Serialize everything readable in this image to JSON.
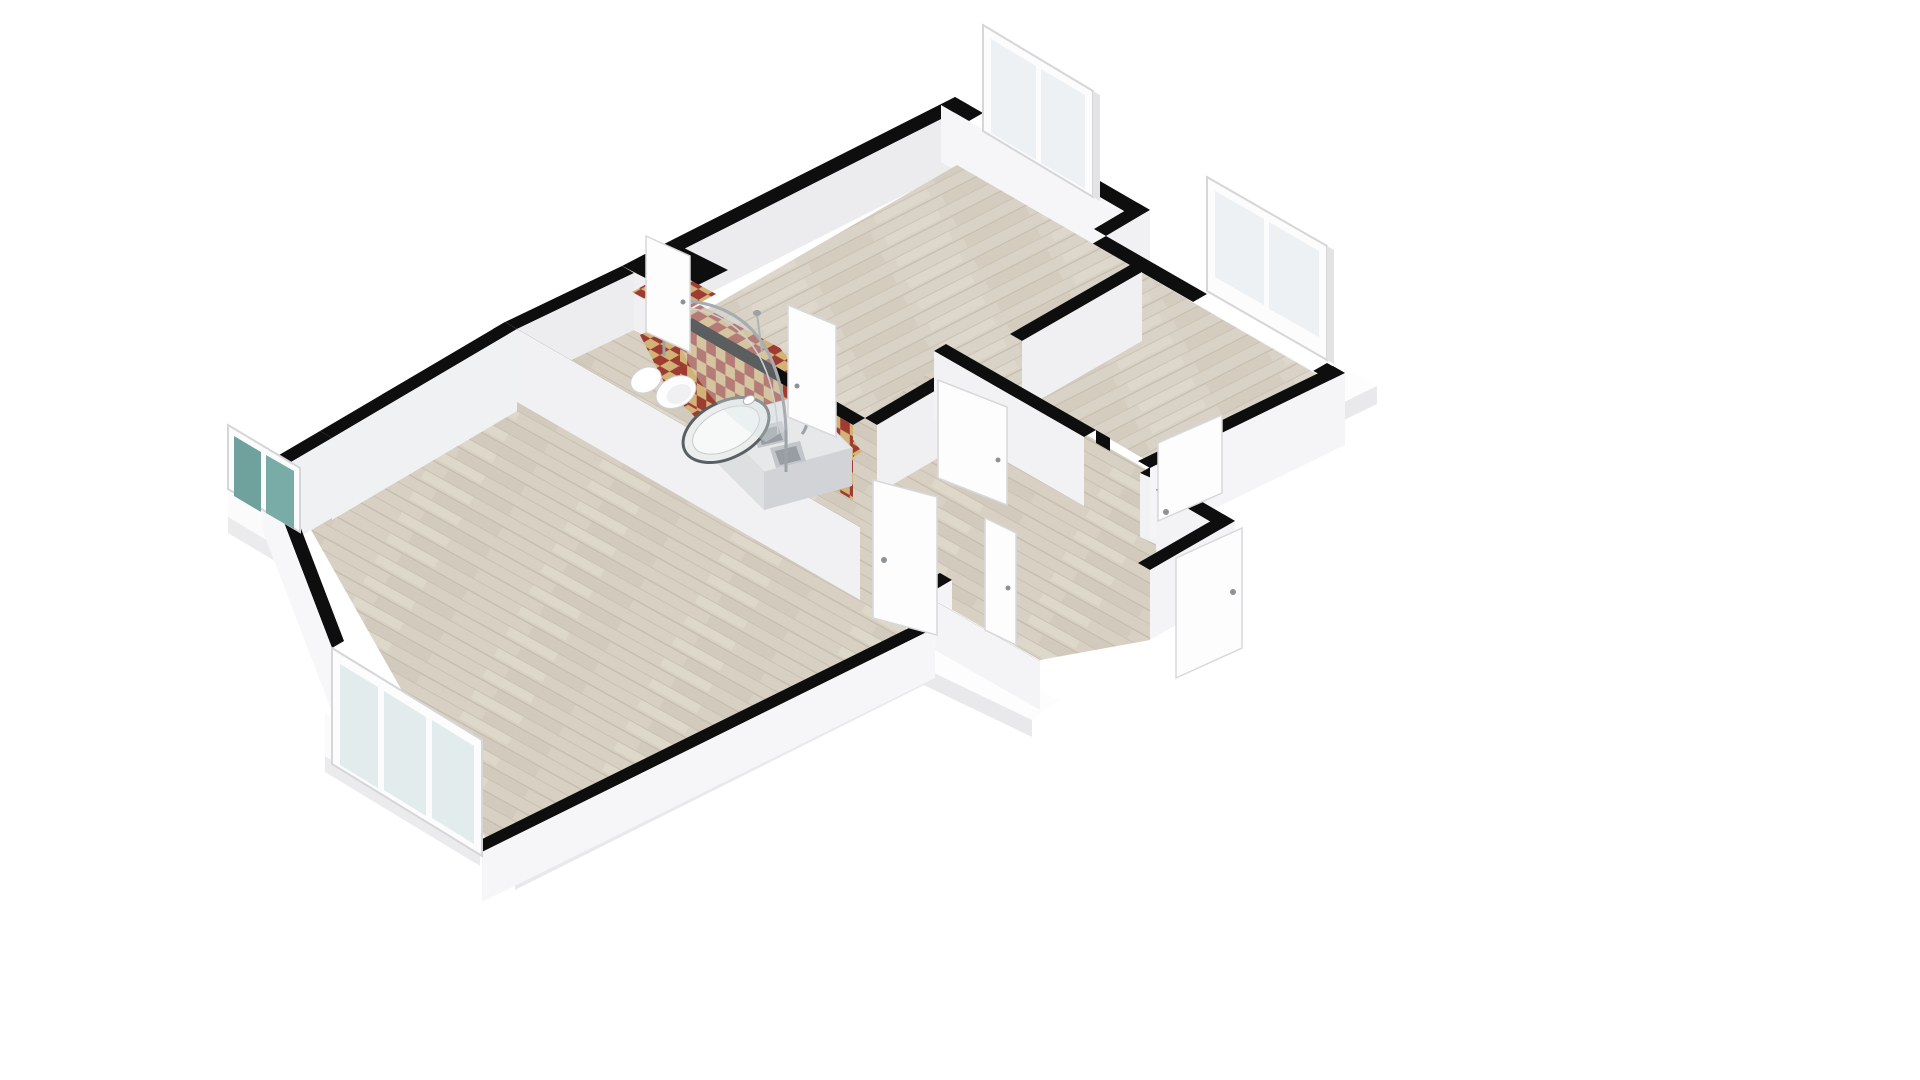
{
  "meta": {
    "view": "3d-floorplan-isometric",
    "background": "#ffffff",
    "canvas": {
      "width": 1920,
      "height": 1080
    }
  },
  "colors": {
    "wall_top": "#0e0e0e",
    "wall_face_bright": "#f6f6f8",
    "wall_face_light": "#f1f1f3",
    "wall_face_med": "#ececee",
    "wood_base": "#d9d2c6",
    "wood_stripe": "#cfc7b8",
    "tile_red": "#9e3c34",
    "tile_tan": "#d2b377",
    "window_frame": "#fcfcfd",
    "window_frame_edge": "#d6d6d9",
    "glass_pale": "#edf1f3",
    "glass_teal": "#6fa29d",
    "slab_top": "#fdfdfe",
    "slab_side": "#e9e9eb",
    "counter_top": "#e7e8ea",
    "counter_front": "#d1d3d6",
    "sink_metal": "#c2c6ca",
    "sink_inner": "#979da2",
    "fixture_white": "#fdfdfe",
    "shower_frame": "#a8acb0",
    "door_white": "#fdfdfe",
    "door_edge": "#d8d8db",
    "handle": "#8d9296"
  },
  "scene": [
    {
      "n": "slab-right-top",
      "t": "poly",
      "p": "1345,368 1377,386 1182,481 1150,463",
      "f": "#fdfdfe"
    },
    {
      "n": "slab-right-side",
      "t": "poly",
      "p": "1377,386 1377,404 1182,499 1182,481",
      "f": "#e9e9eb"
    },
    {
      "n": "slab-south-top",
      "t": "poly",
      "p": "935,628 968,645 515,872 482,852",
      "f": "#fdfdfe"
    },
    {
      "n": "slab-south-side",
      "t": "poly",
      "p": "968,645 968,663 515,890 515,872",
      "f": "#e9e9eb"
    },
    {
      "n": "slab-southwest-top",
      "t": "poly",
      "p": "325,712 480,806 480,850 325,756",
      "f": "#fbfbfc"
    },
    {
      "n": "slab-southwest-side",
      "t": "poly",
      "p": "325,756 480,850 480,866 325,772",
      "f": "#ebebed"
    },
    {
      "n": "slab-west-top",
      "t": "poly",
      "p": "228,492 300,535 300,560 228,517",
      "f": "#fbfbfc"
    },
    {
      "n": "slab-west-side",
      "t": "poly",
      "p": "228,517 300,560 300,576 228,533",
      "f": "#ebebed"
    },
    {
      "n": "slab-entry-top",
      "t": "poly",
      "p": "935,640 1060,700 1032,720 907,660",
      "f": "#fdfdfe"
    },
    {
      "n": "slab-entry-side",
      "t": "poly",
      "p": "907,660 1032,720 1032,737 907,677",
      "f": "#e9e9eb"
    },
    {
      "n": "room1-nw-wall-top",
      "t": "poly",
      "p": "955,97 670,241 684,249 969,105",
      "f": "#0e0e0e"
    },
    {
      "n": "room1-nw-wall-face",
      "t": "poly",
      "p": "969,105 684,249 684,306 969,162",
      "f": "#ececee"
    },
    {
      "n": "bath-niche-top",
      "t": "poly",
      "p": "670,241 728,270 678,295 622,266",
      "f": "#0e0e0e"
    },
    {
      "n": "bath-niche-face-sw",
      "t": "poly",
      "p": "622,266 678,295 678,352 622,323",
      "f": "#f0f0f2"
    },
    {
      "n": "bath-west-wall-top",
      "t": "poly",
      "p": "622,266 505,322 517,329 634,273",
      "f": "#0e0e0e"
    },
    {
      "n": "bath-west-wall-face",
      "t": "poly",
      "p": "634,273 517,329 517,386 634,330",
      "f": "#ededef"
    },
    {
      "n": "room1-ne-wall-top-a",
      "t": "poly",
      "p": "955,97 983,113 969,121 941,105",
      "f": "#0e0e0e"
    },
    {
      "n": "room1-ne-wall-top-b",
      "t": "poly",
      "p": "1093,177 1150,210 1136,218 1079,185",
      "f": "#0e0e0e"
    },
    {
      "n": "room1-ne-wall-face",
      "t": "poly",
      "p": "941,105 1136,218 1136,275 941,162",
      "f": "#f6f6f8"
    },
    {
      "n": "window1-frame",
      "t": "poly",
      "p": "983,25 1093,91 1093,197 983,131",
      "f": "#fcfcfd",
      "s": "#d6d6d9",
      "sw": 2
    },
    {
      "n": "window1-glass-left",
      "t": "poly",
      "p": "991,39 1036,66 1036,160 991,133",
      "f": "#edf1f3"
    },
    {
      "n": "window1-glass-right",
      "t": "poly",
      "p": "1041,69 1085,95 1085,189 1041,163",
      "f": "#edf1f3"
    },
    {
      "n": "window1-edge",
      "t": "poly",
      "p": "1093,91 1100,95 1100,201 1093,197",
      "f": "#e3e3e6"
    },
    {
      "n": "step-wall-top",
      "t": "poly",
      "p": "1150,210 1106,236 1094,229 1138,203",
      "f": "#0e0e0e"
    },
    {
      "n": "step-wall-face",
      "t": "poly",
      "p": "1150,210 1106,236 1106,293 1150,267",
      "f": "#f1f1f3"
    },
    {
      "n": "room2-ne-wall-top-a",
      "t": "poly",
      "p": "1106,236 1207,294 1193,302 1092,244",
      "f": "#0e0e0e"
    },
    {
      "n": "room2-ne-wall-top-b",
      "t": "poly",
      "p": "1327,363 1345,373 1331,381 1313,371",
      "f": "#0e0e0e"
    },
    {
      "n": "room2-ne-wall-face",
      "t": "poly",
      "p": "1092,244 1331,381 1331,438 1092,301",
      "f": "#f6f6f8"
    },
    {
      "n": "window2-frame",
      "t": "poly",
      "p": "1207,177 1327,246 1327,360 1207,291",
      "f": "#fcfcfd",
      "s": "#d6d6d9",
      "sw": 2
    },
    {
      "n": "window2-glass-left",
      "t": "poly",
      "p": "1215,191 1264,219 1264,305 1215,277",
      "f": "#edf1f3"
    },
    {
      "n": "window2-glass-right",
      "t": "poly",
      "p": "1269,222 1319,251 1319,337 1269,309",
      "f": "#edf1f3"
    },
    {
      "n": "window2-edge",
      "t": "poly",
      "p": "1327,246 1334,250 1334,364 1327,360",
      "f": "#e3e3e6"
    },
    {
      "n": "room1-floor",
      "t": "poly",
      "p": "957,165 1130,265 865,418 692,318",
      "f": "url(#woodV)"
    },
    {
      "n": "room2-floor",
      "t": "poly",
      "p": "1106,252 1330,382 1170,474 946,344",
      "f": "url(#woodV)"
    },
    {
      "n": "hall-floor",
      "t": "poly",
      "p": "517,386 634,330 678,352 700,330 865,418 952,357 1168,482 1235,521 1150,640 1040,660 935,600 866,596",
      "f": "url(#woodU)"
    },
    {
      "n": "bottomroom-floor",
      "t": "poly",
      "p": "517,386 862,586 928,624 488,843 310,528",
      "f": "url(#woodU)"
    },
    {
      "n": "bath-floor-tile-niche",
      "t": "poly",
      "p": "632,292 672,270 716,294 676,316",
      "f": "url(#checkF)"
    },
    {
      "n": "bath-floor-tile",
      "t": "poly",
      "p": "640,335 700,305 780,348 846,430 862,452 800,486 742,464 668,390",
      "f": "url(#checkF)"
    },
    {
      "n": "bath-ne-wall-top",
      "t": "poly",
      "p": "692,318 865,418 853,425 680,325",
      "f": "#0e0e0e"
    },
    {
      "n": "bath-ne-wall-tiled-face",
      "t": "poly",
      "p": "680,325 853,425 853,500 680,400",
      "f": "url(#checkW)"
    },
    {
      "n": "room1-se-wall-top-a",
      "t": "poly",
      "p": "1130,265 1010,334 1022,341 1142,272",
      "f": "#0e0e0e"
    },
    {
      "n": "room1-se-wall-face-a",
      "t": "poly",
      "p": "1142,272 1022,341 1022,410 1142,341",
      "f": "#f0f0f2"
    },
    {
      "n": "doorjamb-room1",
      "t": "poly",
      "p": "925,435 943,445 943,458 925,448",
      "f": "#0e0e0e"
    },
    {
      "n": "room1-se-wall-top-b",
      "t": "poly",
      "p": "938,375 865,418 877,425 950,382",
      "f": "#0e0e0e"
    },
    {
      "n": "room1-se-wall-face-b",
      "t": "poly",
      "p": "950,382 877,425 877,494 950,451",
      "f": "#f0f0f2"
    },
    {
      "n": "room2-sw-wall-top-a",
      "t": "poly",
      "p": "946,344 1096,430 1084,437 934,351",
      "f": "#0e0e0e"
    },
    {
      "n": "room2-sw-wall-face-a",
      "t": "poly",
      "p": "934,351 1084,437 1084,506 934,420",
      "f": "#f2f2f4"
    },
    {
      "n": "doorjamb-room2",
      "t": "poly",
      "p": "1096,430 1110,438 1110,451 1096,443",
      "f": "#0e0e0e"
    },
    {
      "n": "room2-sw-wall-top-b",
      "t": "poly",
      "p": "1152,466 1170,474 1158,481 1140,473",
      "f": "#0e0e0e"
    },
    {
      "n": "room2-sw-wall-face-b",
      "t": "poly",
      "p": "1140,473 1158,481 1158,545 1140,537",
      "f": "#f2f2f4"
    },
    {
      "n": "room2-se-wall-top",
      "t": "poly",
      "p": "1345,373 1150,468 1138,461 1333,366",
      "f": "#0e0e0e"
    },
    {
      "n": "room2-se-wall-face",
      "t": "poly",
      "p": "1345,373 1150,468 1150,540 1345,445",
      "f": "#f5f5f7"
    },
    {
      "n": "hall-sw-wall-top",
      "t": "poly",
      "p": "505,322 860,527 848,534 493,329",
      "f": "#0e0e0e"
    },
    {
      "n": "hall-sw-wall-face",
      "t": "poly",
      "p": "505,322 860,527 860,600 505,395",
      "f": "#f1f1f3"
    },
    {
      "n": "hall-post-top",
      "t": "poly",
      "p": "940,573 952,580 940,587 928,580",
      "f": "#0e0e0e"
    },
    {
      "n": "hall-post-face",
      "t": "poly",
      "p": "940,573 952,580 952,650 940,643",
      "f": "#f1f1f3"
    },
    {
      "n": "entry-left-wall-top",
      "t": "poly",
      "p": "952,580 906,607 894,600 940,573",
      "f": "#0e0e0e"
    },
    {
      "n": "entry-left-wall-face",
      "t": "poly",
      "p": "952,580 906,607 906,668 952,641",
      "f": "#f4f4f6"
    },
    {
      "n": "entry-se-wall-top",
      "t": "poly",
      "p": "935,601 1040,661 1028,668 923,608",
      "f": "#0e0e0e"
    },
    {
      "n": "entry-se-wall-face",
      "t": "poly",
      "p": "935,601 1040,661 1040,710 935,650",
      "f": "#f4f4f6"
    },
    {
      "n": "entry-ne-wall-top",
      "t": "poly",
      "p": "1168,482 1235,521 1223,529 1156,490",
      "f": "#0e0e0e"
    },
    {
      "n": "entry-ne-wall-face",
      "t": "poly",
      "p": "1156,490 1223,529 1223,600 1156,561",
      "f": "#f3f3f5"
    },
    {
      "n": "entry-end-wall-top",
      "t": "poly",
      "p": "1235,521 1150,570 1138,563 1223,514",
      "f": "#0e0e0e"
    },
    {
      "n": "entry-end-wall-face",
      "t": "poly",
      "p": "1150,570 1235,521 1235,591 1150,640",
      "f": "#f4f4f6"
    },
    {
      "n": "bottomroom-nw-wall-top-a",
      "t": "poly",
      "p": "505,322 320,431 332,438 517,329",
      "f": "#0e0e0e"
    },
    {
      "n": "bottomroom-nw-wall-face-a",
      "t": "poly",
      "p": "517,329 332,438 332,520 517,411",
      "f": "#f0f1f2"
    },
    {
      "n": "bottomroom-nw-wall-top-b",
      "t": "poly",
      "p": "320,431 262,465 274,472 332,438",
      "f": "#0e0e0e"
    },
    {
      "n": "bottomroom-nw-wall-face-b",
      "t": "poly",
      "p": "332,438 274,472 274,552 332,518",
      "f": "#f0f1f2"
    },
    {
      "n": "bottomroom-sw-wall-top",
      "t": "poly",
      "p": "262,465 332,648 344,641 274,458",
      "f": "#0e0e0e"
    },
    {
      "n": "bottomroom-sw-wall-face",
      "t": "poly",
      "p": "262,465 332,648 332,712 262,529",
      "f": "#f7f7f9"
    },
    {
      "n": "bottomroom-se-wall-top",
      "t": "poly",
      "p": "482,852 935,628 923,621 470,845",
      "f": "#0e0e0e"
    },
    {
      "n": "bottomroom-se-wall-face",
      "t": "poly",
      "p": "482,852 935,628 935,678 482,902",
      "f": "#f6f6f8"
    },
    {
      "n": "kitchen-counter-top",
      "t": "poly",
      "p": "712,420 800,396 852,448 764,472",
      "f": "#e7e8ea",
      "s": "#d8d9db",
      "sw": 1
    },
    {
      "n": "kitchen-counter-front",
      "t": "poly",
      "p": "764,472 852,448 852,486 764,510",
      "f": "#d1d3d6"
    },
    {
      "n": "kitchen-counter-left",
      "t": "poly",
      "p": "712,420 764,472 764,510 712,458",
      "f": "#dddfe1"
    },
    {
      "n": "sink-basin1",
      "t": "poly",
      "p": "752,428 782,421 788,441 758,448",
      "f": "#c2c6ca"
    },
    {
      "n": "sink-basin1-inner",
      "t": "poly",
      "p": "757,431 778,426 783,440 762,445",
      "f": "#979da2"
    },
    {
      "n": "sink-basin2",
      "t": "poly",
      "p": "770,448 800,441 806,461 776,468",
      "f": "#c2c6ca"
    },
    {
      "n": "sink-basin2-inner",
      "t": "poly",
      "p": "775,451 796,446 801,460 780,465",
      "f": "#979da2"
    },
    {
      "n": "sink-faucet",
      "t": "path",
      "d": "M 802,434 q 8,-10 2,-18",
      "f": "none",
      "s": "#9aa0a5",
      "sw": 3
    },
    {
      "n": "toilet-tank",
      "t": "ellipse",
      "cx": 646,
      "cy": 380,
      "rx": 16,
      "ry": 12,
      "tr": "rotate(-27 646 380)",
      "f": "#ffffff",
      "s": "#d2d2d5",
      "sw": 1
    },
    {
      "n": "toilet-bowl",
      "t": "ellipse",
      "cx": 676,
      "cy": 392,
      "rx": 21,
      "ry": 15,
      "tr": "rotate(-27 676 392)",
      "f": "#fdfdfe",
      "s": "#cfcfd2",
      "sw": 1
    },
    {
      "n": "toilet-seat",
      "t": "ellipse",
      "cx": 679,
      "cy": 394,
      "rx": 13,
      "ry": 9,
      "tr": "rotate(-27 679 394)",
      "f": "#f0f0f2"
    },
    {
      "n": "shower-tray",
      "t": "ellipse",
      "cx": 726,
      "cy": 430,
      "rx": 46,
      "ry": 28,
      "tr": "rotate(-27 726 430)",
      "f": "#eceeed",
      "s": "#5a5f63",
      "sw": 3
    },
    {
      "n": "shower-tray-inner",
      "t": "ellipse",
      "cx": 726,
      "cy": 430,
      "rx": 36,
      "ry": 20,
      "tr": "rotate(-27 726 430)",
      "f": "#f7f8f8",
      "s": "#c8cbcd",
      "sw": 1
    },
    {
      "n": "shower-glass-film",
      "t": "path",
      "d": "M 664,300 Q 780,296 786,430 L 766,442 Q 690,400 664,300 Z",
      "f": "rgba(215,225,230,0.38)"
    },
    {
      "n": "shower-glass-outer",
      "t": "path",
      "d": "M 664,300 Q 780,296 786,430",
      "f": "none",
      "s": "#a8acb0",
      "sw": 3
    },
    {
      "n": "shower-glass-inner",
      "t": "path",
      "d": "M 658,306 Q 772,303 778,434",
      "f": "none",
      "s": "#cdd0d2",
      "sw": 1.5
    },
    {
      "n": "shower-post-left",
      "t": "line",
      "x1": 664,
      "y1": 296,
      "x2": 664,
      "y2": 356,
      "s": "#9da2a6",
      "sw": 3
    },
    {
      "n": "shower-post-right",
      "t": "line",
      "x1": 786,
      "y1": 430,
      "x2": 786,
      "y2": 472,
      "s": "#9da2a6",
      "sw": 3
    },
    {
      "n": "shower-riser",
      "t": "line",
      "x1": 757,
      "y1": 314,
      "x2": 762,
      "y2": 352,
      "s": "#b0b4b8",
      "sw": 2
    },
    {
      "n": "shower-head",
      "t": "ellipse",
      "cx": 757,
      "cy": 313,
      "rx": 4,
      "ry": 3,
      "f": "#9aa0a4"
    },
    {
      "n": "shower-mixer",
      "t": "ellipse",
      "cx": 749,
      "cy": 400,
      "rx": 6,
      "ry": 4,
      "tr": "rotate(-27 749 400)",
      "f": "#ffffff",
      "s": "#b0b4b8",
      "sw": 1
    },
    {
      "n": "door-bath-a",
      "t": "poly",
      "p": "646,236 690,256 690,352 646,332",
      "f": "#fdfdfe",
      "s": "#d8d8db",
      "sw": 1.5
    },
    {
      "n": "door-bath-a-handle",
      "t": "ellipse",
      "cx": 683,
      "cy": 302,
      "rx": 2.5,
      "ry": 2.5,
      "f": "#8d9296"
    },
    {
      "n": "door-bath-c",
      "t": "poly",
      "p": "788,305 836,325 836,437 788,417",
      "f": "#fdfdfe",
      "s": "#d8d8db",
      "sw": 1.5
    },
    {
      "n": "door-bath-c-handle",
      "t": "ellipse",
      "cx": 797,
      "cy": 386,
      "rx": 2.5,
      "ry": 2.5,
      "f": "#8d9296"
    },
    {
      "n": "door-room1",
      "t": "poly",
      "p": "938,380 1007,407 1007,505 938,478",
      "f": "#fdfdfe",
      "s": "#d8d8db",
      "sw": 1.5
    },
    {
      "n": "door-room1-handle",
      "t": "ellipse",
      "cx": 998,
      "cy": 460,
      "rx": 2.5,
      "ry": 2.5,
      "f": "#8d9296"
    },
    {
      "n": "door-bottomroom",
      "t": "poly",
      "p": "873,480 937,497 937,635 873,618",
      "f": "#fdfdfe",
      "s": "#d8d8db",
      "sw": 1.5
    },
    {
      "n": "door-bottomroom-handle",
      "t": "ellipse",
      "cx": 884,
      "cy": 560,
      "rx": 3,
      "ry": 3,
      "f": "#8d9296"
    },
    {
      "n": "door-entry-f",
      "t": "poly",
      "p": "985,518 1016,533 1016,645 985,630",
      "f": "#fdfdfe",
      "s": "#d8d8db",
      "sw": 1.5
    },
    {
      "n": "door-entry-f-handle",
      "t": "ellipse",
      "cx": 1008,
      "cy": 588,
      "rx": 2.5,
      "ry": 2.5,
      "f": "#8d9296"
    },
    {
      "n": "door-room2",
      "t": "poly",
      "p": "1158,443 1222,415 1222,493 1158,521",
      "f": "#fdfdfe",
      "s": "#d8d8db",
      "sw": 1.5
    },
    {
      "n": "door-room2-handle",
      "t": "ellipse",
      "cx": 1166,
      "cy": 512,
      "rx": 3,
      "ry": 3,
      "f": "#8d9296"
    },
    {
      "n": "door-entry-h",
      "t": "poly",
      "p": "1176,558 1242,528 1242,648 1176,678",
      "f": "#fdfdfe",
      "s": "#d8d8db",
      "sw": 1.5
    },
    {
      "n": "door-entry-h-handle",
      "t": "ellipse",
      "cx": 1233,
      "cy": 592,
      "rx": 3,
      "ry": 3,
      "f": "#8d9296"
    },
    {
      "n": "window4-frame",
      "t": "poly",
      "p": "228,425 300,468 300,532 228,489",
      "f": "#fcfcfd",
      "s": "#d6d6d9",
      "sw": 2
    },
    {
      "n": "window4-glass-left",
      "t": "poly",
      "p": "234,436 261,452 261,512 234,496",
      "f": "#6fa29d"
    },
    {
      "n": "window4-glass-right",
      "t": "poly",
      "p": "266,455 294,471 294,529 266,513",
      "f": "#7aaca7"
    },
    {
      "n": "window5-frame",
      "t": "poly",
      "p": "332,648 482,740 482,856 332,764",
      "f": "#fcfcfd",
      "s": "#d6d6d9",
      "sw": 2
    },
    {
      "n": "window5-glass-1",
      "t": "poly",
      "p": "340,664 378,687 378,788 340,765",
      "f": "#e3ecec"
    },
    {
      "n": "window5-glass-2",
      "t": "poly",
      "p": "384,691 426,717 426,816 384,790",
      "f": "#e3ecec"
    },
    {
      "n": "window5-glass-3",
      "t": "poly",
      "p": "432,720 474,746 474,844 432,818",
      "f": "#e3ecec"
    }
  ]
}
